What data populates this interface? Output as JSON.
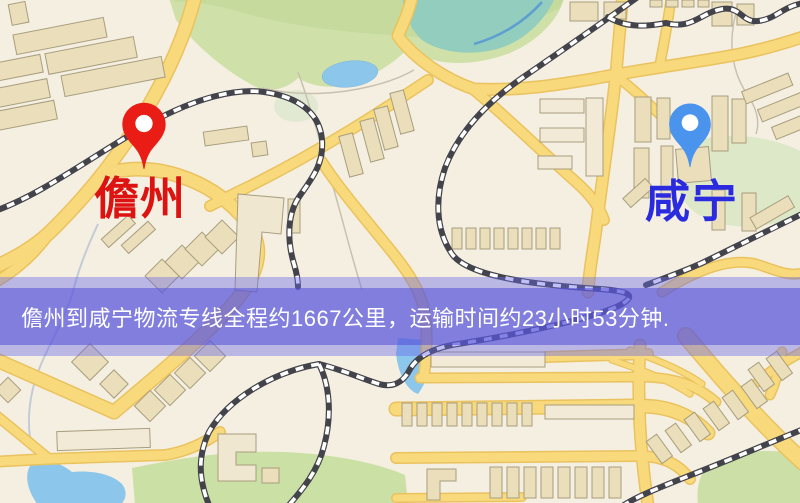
{
  "map": {
    "origin_marker": {
      "label": "儋州",
      "pin_color": "#e91d16",
      "label_color": "#dc1310"
    },
    "destination_marker": {
      "label": "咸宁",
      "pin_color": "#4b94ee",
      "label_color": "#2a2ade"
    }
  },
  "banner": {
    "text": "儋州到咸宁物流专线全程约1667公里，运输时间约23小时53分钟.",
    "origin_city": "儋州",
    "destination_city": "咸宁",
    "distance_km": "1667",
    "duration": "23小时53分钟",
    "text_color": "#ffffff",
    "overlay_color": "#5450d9"
  },
  "map_palette": {
    "background": "#f5efe1",
    "road": "#f8da7c",
    "road_casing": "#eac25e",
    "building": "#eadfba",
    "green_area": "#cfe1a8",
    "water": "#8cc6ea",
    "railway": "#43434b"
  }
}
